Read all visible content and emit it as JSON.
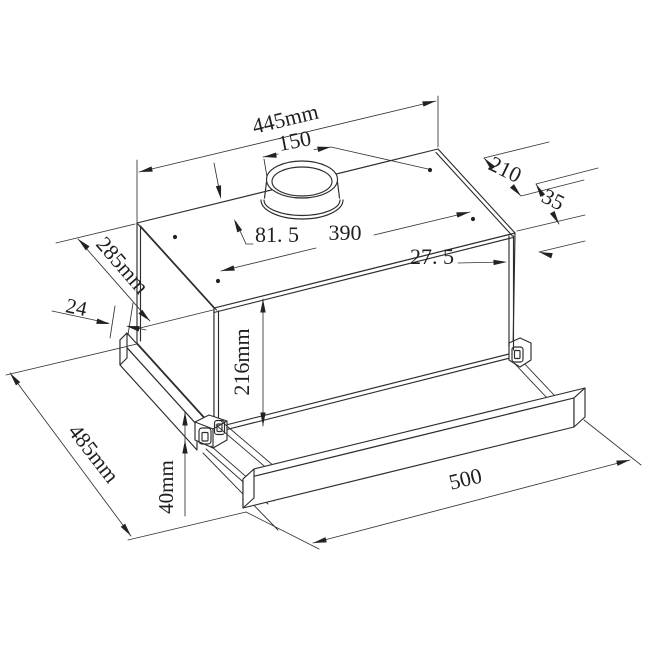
{
  "drawing": {
    "title": "telescopic range hood dimension drawing",
    "unit": "mm",
    "line_color": "#2d2d2d",
    "background": "#ffffff",
    "labels": {
      "top_width": "445mm",
      "duct_diameter": "150",
      "top_depth": "210",
      "rear_offset": "35",
      "duct_offset_left": "81. 5",
      "duct_span": "390",
      "rear_gap": "27. 5",
      "body_depth": "285mm",
      "side_offset": "24",
      "body_height": "216mm",
      "total_depth": "485mm",
      "visor_height": "40mm",
      "handle_length": "500"
    }
  }
}
